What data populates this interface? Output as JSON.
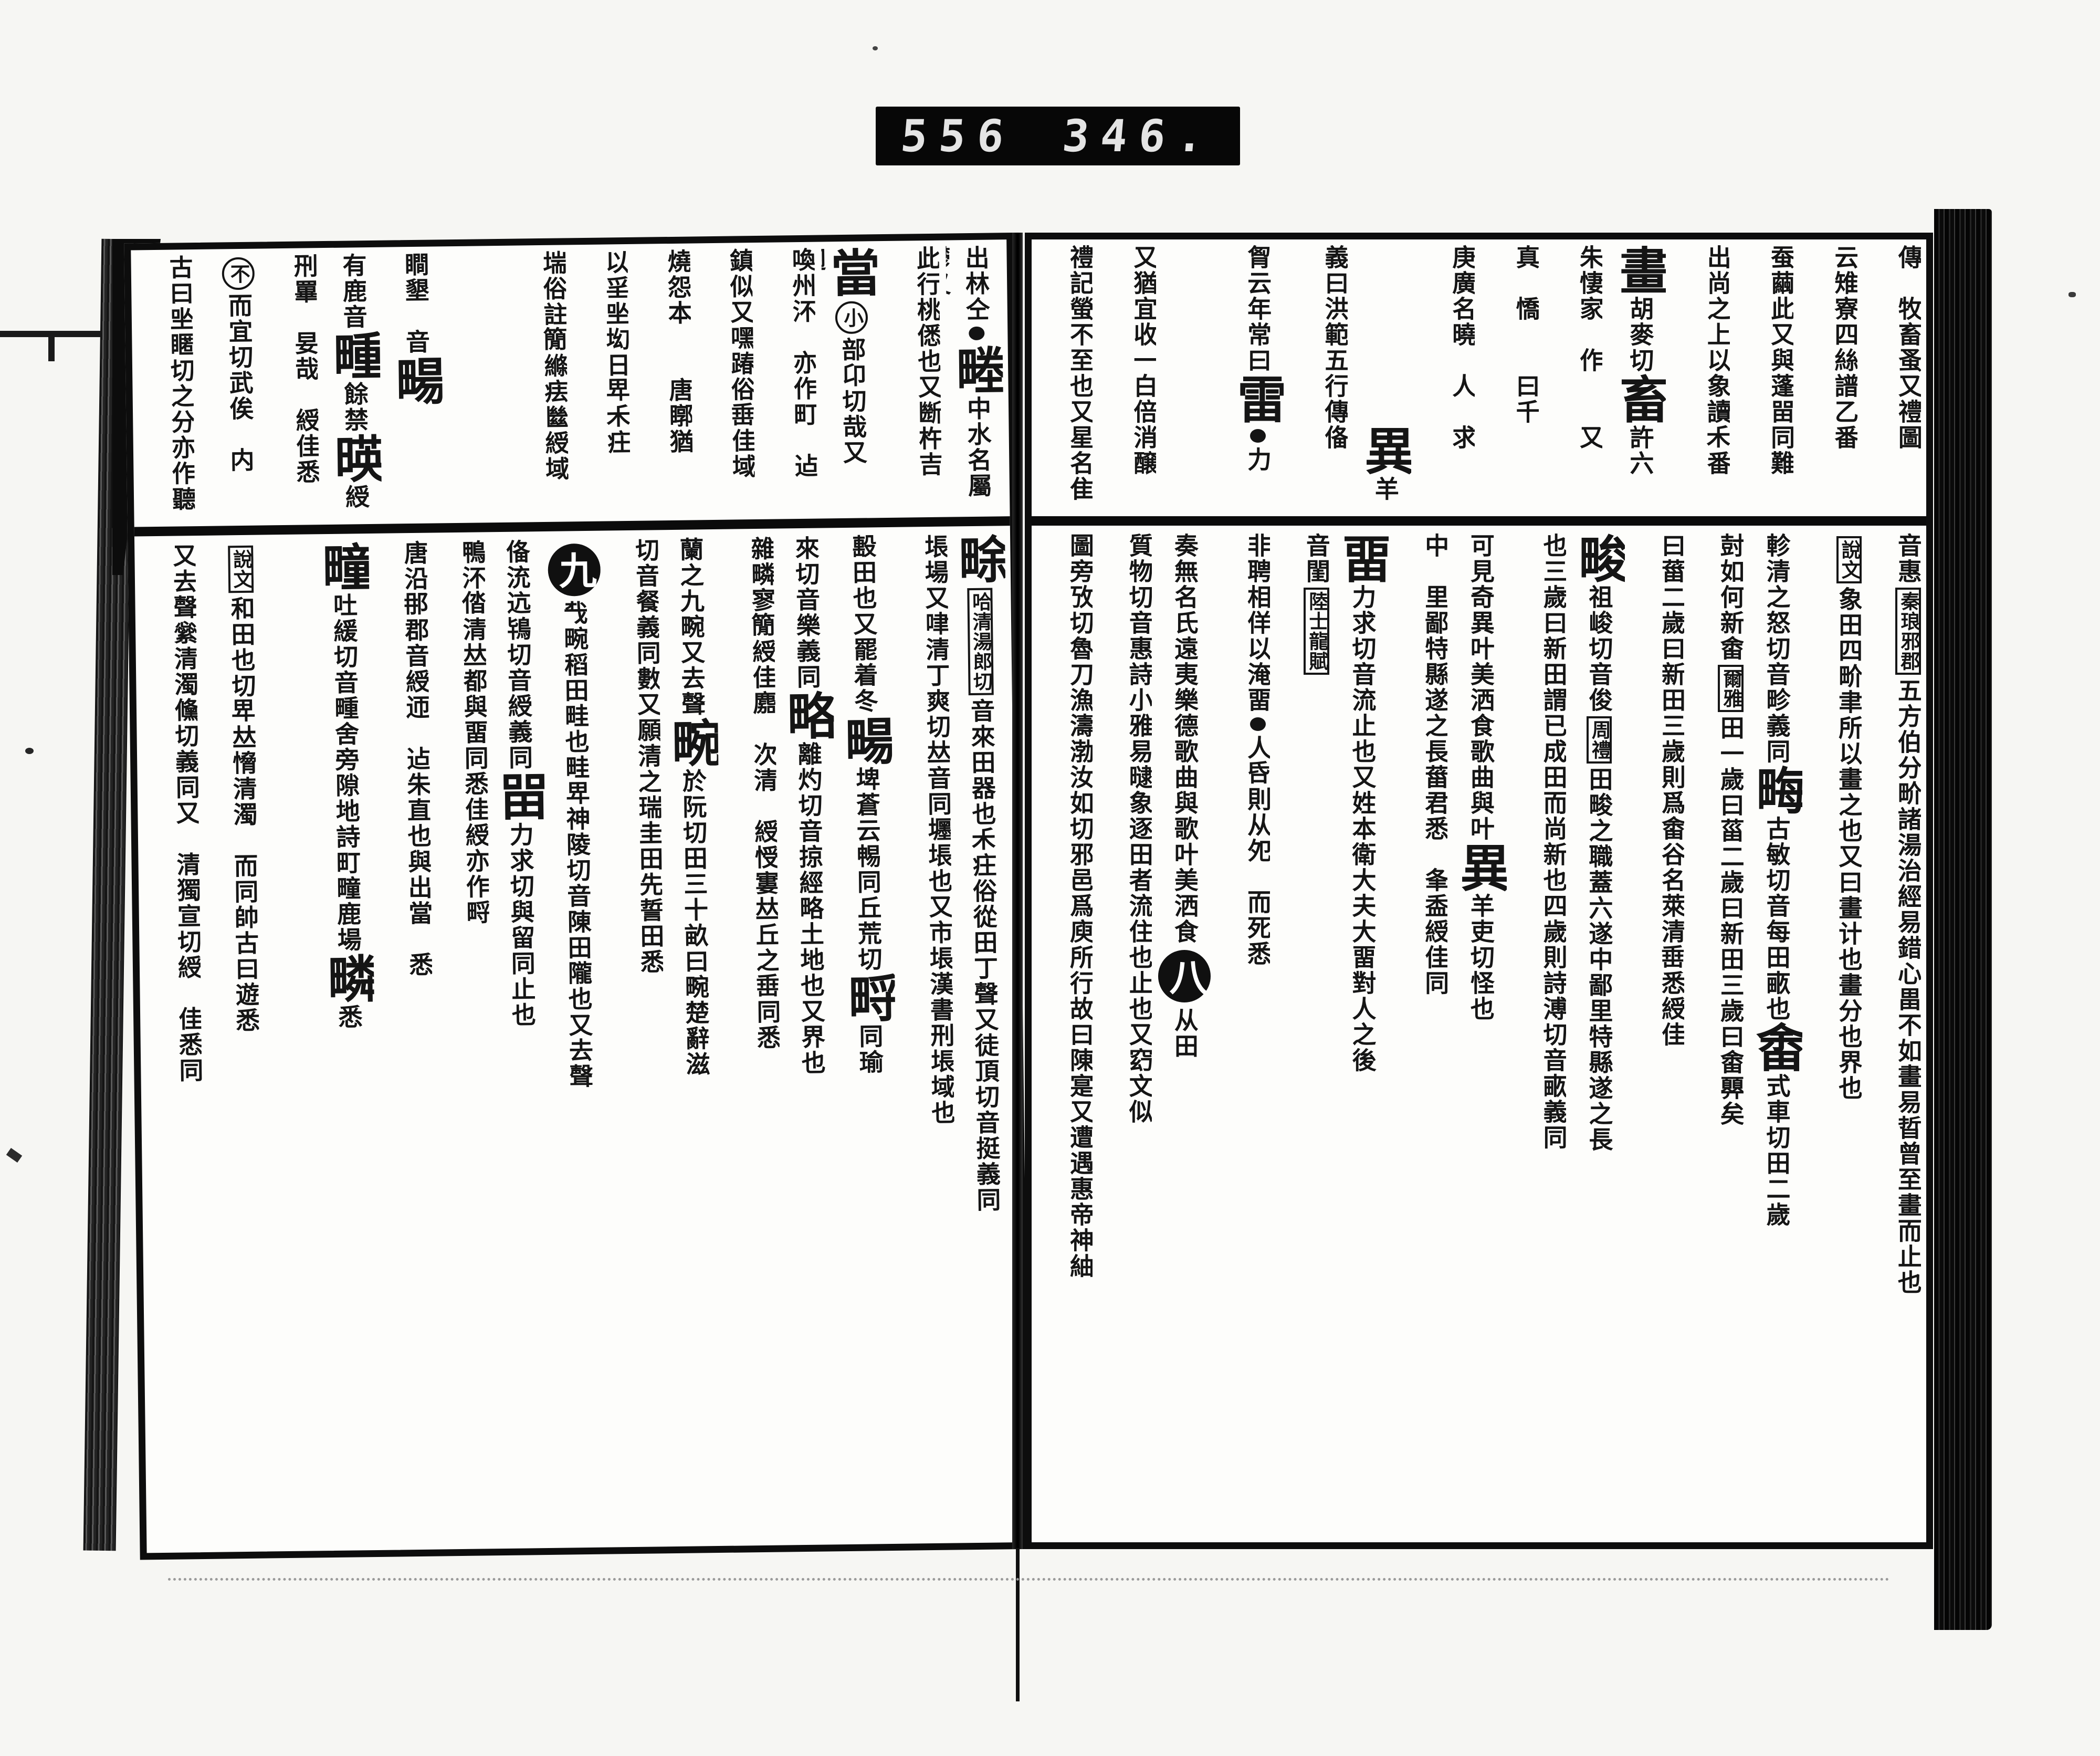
{
  "label": {
    "left": "556",
    "right": "346."
  },
  "marks": {
    "section_left_circle": "九",
    "section_right_circle": "八"
  },
  "spread": {
    "right_page": {
      "top_columns": [
        [
          [
            "s",
            "傳𡫳牧畜蚤又禮圖"
          ]
        ],
        [
          [
            "s",
            "云雉寮四絲譜乙番"
          ]
        ],
        [
          [
            "s",
            "蚕繭此又與蓬㽞同難"
          ]
        ],
        [
          [
            "s",
            "出尚之上以象讀𥝌番"
          ]
        ],
        [
          [
            "b",
            "畫"
          ],
          [
            "s",
            "胡麥切"
          ],
          [
            "b",
            "畜"
          ],
          [
            "s",
            "許六"
          ]
        ],
        [
          [
            "s",
            "朱悽家𠊳作𡫳𡸁又𥳑"
          ]
        ],
        [
          [
            "s",
            "真𠊳憍𨋮𠃔曰千𥝌"
          ]
        ],
        [
          [
            "s",
            "庚廣名曉𠊳人𪁐求"
          ]
        ],
        [
          [
            "s",
            "𠯈𢿙㪿𡵨作㫁𣄜"
          ],
          [
            "b",
            "異"
          ],
          [
            "s",
            "羊"
          ]
        ],
        [
          [
            "s",
            "義曰洪範五行傳俻"
          ]
        ],
        [
          [
            "s",
            "胷云年常曰"
          ],
          [
            "b",
            "雷"
          ],
          [
            "d",
            ""
          ],
          [
            "s",
            "力"
          ]
        ],
        [
          [
            "s",
            "𣈆之人急𢚩恆悲𨾏同此"
          ]
        ],
        [
          [
            "s",
            "又猶宜收一白倍消醸"
          ]
        ],
        [
          [
            "s",
            "禮記螢不至也又星名隹"
          ]
        ]
      ],
      "bottom_columns": [
        [
          [
            "s",
            "音惠"
          ],
          [
            "x",
            "秦琅邪郡"
          ],
          [
            "s",
            "五方伯分畍諸湯治經易錯心畕不如畫易晢曾至畫而止也"
          ]
        ],
        [
          [
            "x",
            "說文"
          ],
          [
            "s",
            "象田四畍聿所以畫之也又曰畫计也畫分也界也"
          ]
        ],
        [
          [
            "s",
            "軫清之怒切音畛義同"
          ],
          [
            "b",
            "畮"
          ],
          [
            "s",
            "古敏切音每田畞也"
          ],
          [
            "b",
            "畬"
          ],
          [
            "s",
            "式車切田二歲"
          ]
        ],
        [
          [
            "s",
            "尌如何新畬"
          ],
          [
            "x",
            "爾雅"
          ],
          [
            "s",
            "田一歲曰菑二歲曰新田三歲曰畬顨矣"
          ]
        ],
        [
          [
            "s",
            "曰葘二歲曰新田三歲則爲畬谷名萊清𡸁悉綬佳"
          ]
        ],
        [
          [
            "b",
            "畯"
          ],
          [
            "s",
            "祖峻切音俊"
          ],
          [
            "x",
            "周禮"
          ],
          [
            "s",
            "田畯之職蓋六遂中鄙里特縣遂之長"
          ]
        ],
        [
          [
            "s",
            "也三歲曰新田謂已成田而尚新也四歲則詩溥切音畞義同"
          ]
        ],
        [
          [
            "s",
            "可見奇異叶美洒食歌曲與叶"
          ],
          [
            "b",
            "異"
          ],
          [
            "s",
            "羊吏切怪也"
          ]
        ],
        [
          [
            "s",
            "中𨜮里鄙特縣遂之長葘君悉𨾏夆盉綬佳同"
          ]
        ],
        [
          [
            "b",
            "畱"
          ],
          [
            "s",
            "力求切音流止也又姓本衛大夫大畱對人之後"
          ]
        ],
        [
          [
            "s",
            "音閨"
          ],
          [
            "x",
            "陸士龍賦"
          ],
          [
            "s",
            "𡝫士非𠂢悉曙倍待貌又濡滯也"
          ]
        ],
        [
          [
            "s",
            "非聘相佯以淹畱"
          ],
          [
            "d",
            ""
          ],
          [
            "s",
            "人𠯑則从夗𦝢而死悉"
          ]
        ],
        [
          [
            "s",
            "奏無名氏遠夷樂德歌曲與歌叶美洒食"
          ],
          [
            "C",
            "八"
          ],
          [
            "s",
            "从田𢈻"
          ]
        ],
        [
          [
            "s",
            "質物切音惠詩小雅易曃象逐田者流住也止也又𥥆文似"
          ]
        ],
        [
          [
            "s",
            "圖旁攷切魯刀漁濤渤汝如切邪邑爲庾所行故曰陳寔又遭遇惠帝神紬"
          ]
        ]
      ]
    },
    "left_page": {
      "top_columns": [
        [
          [
            "s",
            "出林仝"
          ],
          [
            "d",
            ""
          ],
          [
            "b",
            "畻"
          ],
          [
            "s",
            "中水名屬鬱又"
          ]
        ],
        [
          [
            "s",
            "此行桃僁也又㫁杵吉"
          ]
        ],
        [
          [
            "b",
            "當"
          ],
          [
            "c",
            "小"
          ],
          [
            "s",
            "部卬切哉又𨓤𢌞"
          ]
        ],
        [
          [
            "s",
            "喚州㳅𨒫亦作町𣥚迠"
          ]
        ],
        [
          [
            "s",
            "鎮似又嘿踳俗𡸁佳域"
          ]
        ],
        [
          [
            "s",
            "燒怨本𦒜𣂾唐䁨猶𡸁"
          ]
        ],
        [
          [
            "s",
            "以㸒㘴㘭日𤰞𥝌㽵"
          ]
        ],
        [
          [
            "s",
            "㙐俗註𥳑縧㾀㡭綬域"
          ]
        ],
        [
          [
            "s",
            "𣢑掾唐㨖𤰝㳅佳綬亦"
          ]
        ],
        [
          [
            "s",
            "瞷墾𠅃音"
          ],
          [
            "b",
            "畼"
          ],
          [
            "s",
            "𥠖不生"
          ]
        ],
        [
          [
            "s",
            "有鹿音"
          ],
          [
            "b",
            "畽"
          ],
          [
            "s",
            "餘禁"
          ],
          [
            "b",
            "暎"
          ],
          [
            "s",
            "綬"
          ]
        ],
        [
          [
            "s",
            "𠛬罼𠯈妟哉𡸁綬佳悉"
          ]
        ],
        [
          [
            "c",
            "不"
          ],
          [
            "s",
            "而宜切武俟𠊳内"
          ]
        ],
        [
          [
            "s",
            "古曰㘴䁥切之分亦作聽"
          ]
        ]
      ],
      "bottom_columns": [
        [
          [
            "b",
            "畭"
          ],
          [
            "x",
            "哈清湯郎切"
          ],
          [
            "s",
            "音來田器也𥝌㽵俗從田丁聲又徒頂切音挺義同"
          ]
        ],
        [
          [
            "s",
            "㙊場又㖀清丁爽切𠀤音同壥㙊也又市㙊漢書刑㙊域也"
          ]
        ],
        [
          [
            "s",
            "𣪠田也又罷着冬"
          ],
          [
            "b",
            "畼"
          ],
          [
            "s",
            "埤蒼云𣈱同丘荒切"
          ],
          [
            "b",
            "㽟"
          ],
          [
            "s",
            "同瑜"
          ]
        ],
        [
          [
            "s",
            "來切音樂義同"
          ],
          [
            "b",
            "略"
          ],
          [
            "s",
            "離灼切音掠經略土地也又界也"
          ]
        ],
        [
          [
            "s",
            "雜疄寥𥳑綬佳䴥𢼮次清𠋣綬㥅寠𠀤丘之𡸁同悉"
          ]
        ],
        [
          [
            "s",
            "蘭之九畹又去聲"
          ],
          [
            "b",
            "畹"
          ],
          [
            "s",
            "於阮切田三十畝曰畹楚辭滋"
          ]
        ],
        [
          [
            "s",
            "切音餐義同數又願清之瑞圭田先誓田悉𦔻"
          ]
        ],
        [
          [
            "C",
            "九"
          ],
          [
            "s",
            "𢦔畹稻田畦也畦𤰞神陵切音陳田隴也又去聲"
          ]
        ],
        [
          [
            "s",
            "俻㳘迒鴇切音綬義同"
          ],
          [
            "b",
            "㽞"
          ],
          [
            "s",
            "力求切與留同止也"
          ]
        ],
        [
          [
            "s",
            "鴨㳅𠉤清𠀤都與畱同悉佳綬亦作㽟"
          ]
        ],
        [
          [
            "s",
            "唐沿𨙻郡音綬迊𣥚迠朱直也與出當𡹔悉𦔻"
          ]
        ],
        [
          [
            "b",
            "疃"
          ],
          [
            "s",
            "吐緩切音畽舍旁隙地詩町疃鹿場"
          ],
          [
            "b",
            "疄"
          ],
          [
            "s",
            "悉"
          ]
        ],
        [
          [
            "s",
            "𠬸佳人爲故𪋮以鷃場𡵨悉佳綬𠀤丘之𡸁同"
          ]
        ],
        [
          [
            "x",
            "說文"
          ],
          [
            "s",
            "和田也切𤰞𠀤愶清濁𨓤而同帥古曰遊悉"
          ]
        ],
        [
          [
            "s",
            "又去聲繠清濁儵切義同又𢴎清獨宣切綬𥝌佳悉同"
          ]
        ]
      ]
    }
  }
}
